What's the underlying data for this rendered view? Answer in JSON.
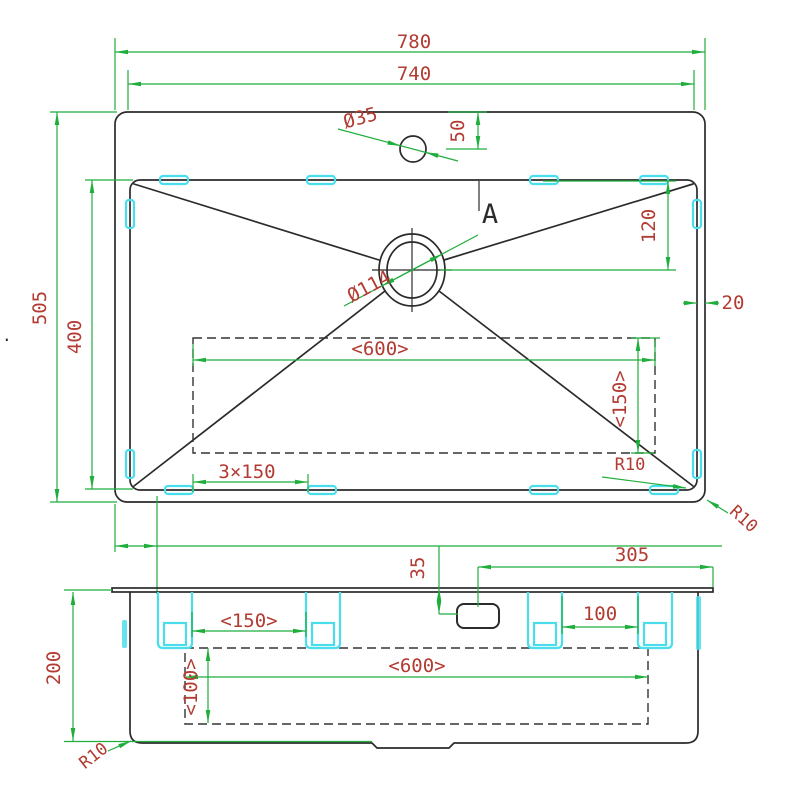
{
  "colors": {
    "dimension_line": "#1fae3c",
    "dimension_text": "#b23b32",
    "mounting_clip": "#4adeec",
    "outline": "#2b2b2b"
  },
  "top_view": {
    "overall_width": "780",
    "bowl_width": "740",
    "faucet_hole_diameter": "Ø35",
    "faucet_center_offset": "50",
    "section_marker": "A",
    "drain_center_offset": "120",
    "rim_gap": "20",
    "overall_depth": "505",
    "bowl_depth": "400",
    "drain_diameter": "Ø114",
    "groove_width": "<600>",
    "groove_depth": "<150>",
    "clip_pitch": "3×150",
    "bowl_corner_radius": "R10",
    "outer_corner_radius": "R10"
  },
  "front_view": {
    "faucet_hole_drop": "35",
    "faucet_to_right_edge": "305",
    "body_height": "200",
    "clip_spacing_left": "<150>",
    "clip_spacing_right": "100",
    "groove_width": "<600>",
    "groove_depth": "<100>",
    "corner_radius": "R10"
  },
  "stray_mark": "."
}
